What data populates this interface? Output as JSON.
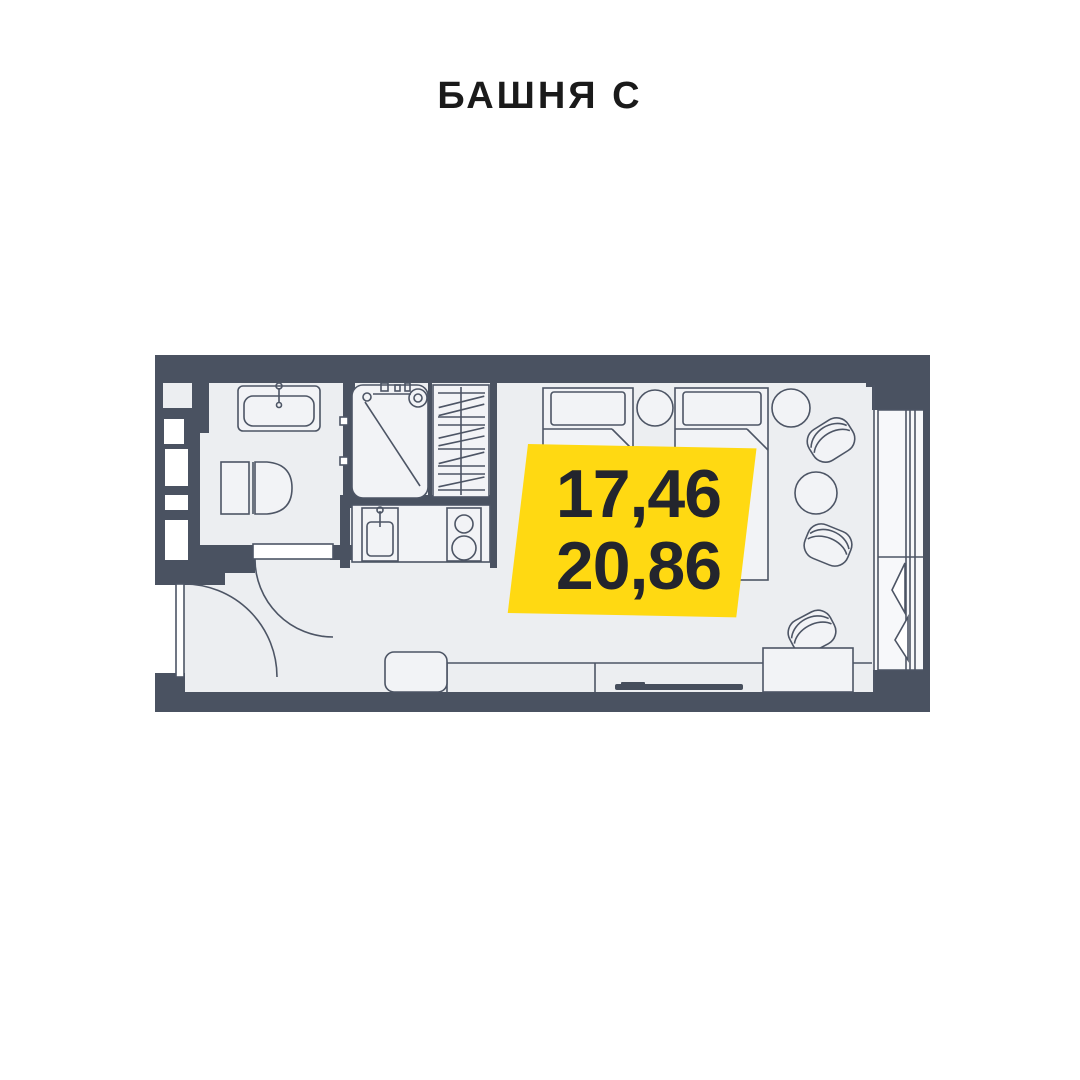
{
  "title": "БАШНЯ С",
  "badge": {
    "area_top": "17,46",
    "area_bottom": "20,86"
  },
  "colors": {
    "wall": "#4A5261",
    "outline": "#4D5565",
    "floor": "#ECEEF1",
    "furn": "#F2F3F6",
    "balcony": "#F7F8FA",
    "yellow": "#FFD912",
    "badge_text": "#23252D",
    "title": "#1A1A1A",
    "tv": "#464E5C"
  },
  "fixtures": [
    "bathroom-sink-icon",
    "toilet-icon",
    "shower-icon",
    "wardrobe-hangers-icon",
    "kitchen-sink-icon",
    "stove-icon",
    "entrance-door-icon",
    "bathroom-door-icon",
    "bed-icon",
    "bed-icon",
    "side-table-icon",
    "side-table-icon",
    "round-table-icon",
    "armchair-icon",
    "armchair-icon",
    "armchair-icon",
    "desk-icon",
    "media-counter-icon",
    "tv-icon",
    "stool-icon",
    "balcony-glazing-icon"
  ]
}
